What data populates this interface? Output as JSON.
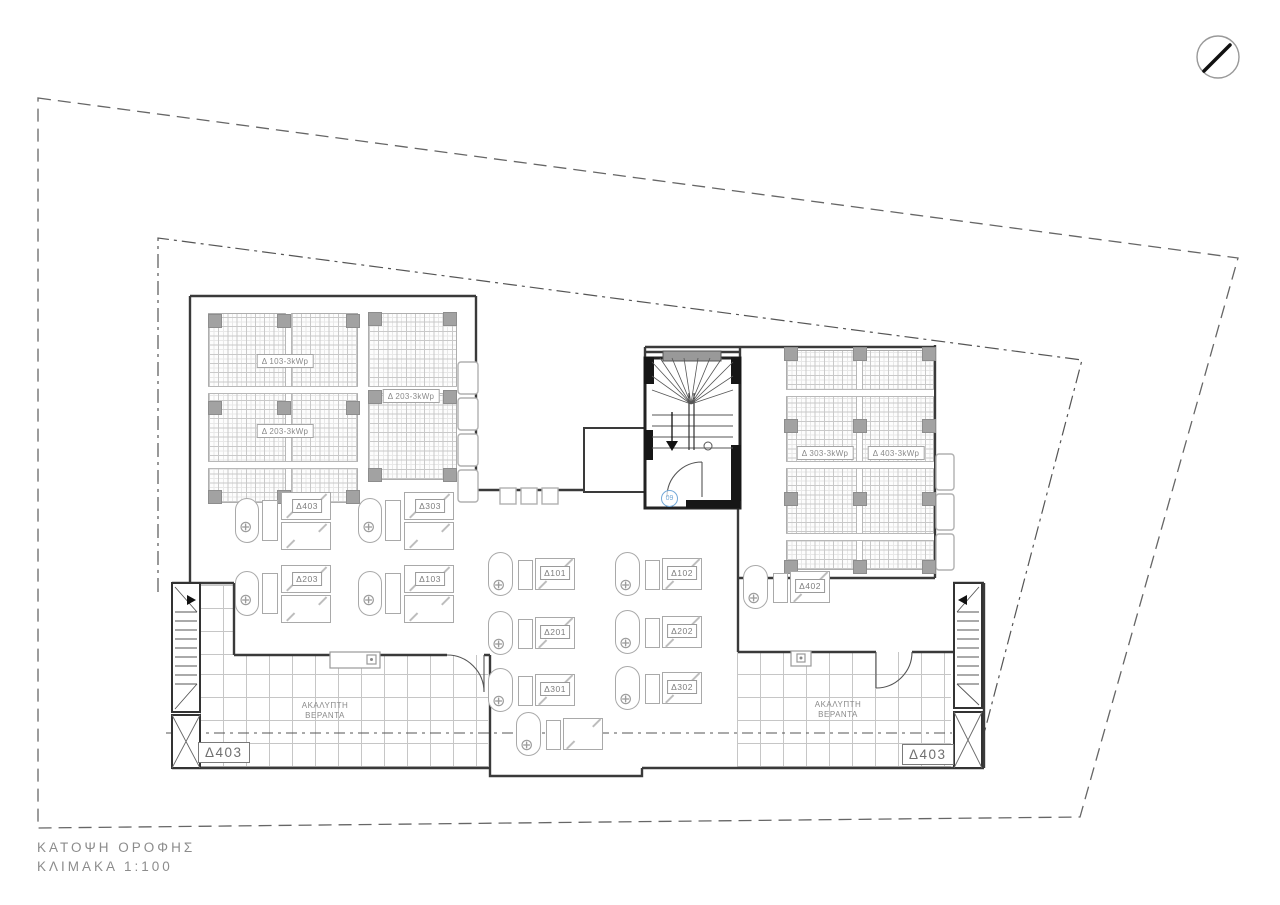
{
  "drawing": {
    "title": "ΚΑΤΟΨΗ ΟΡΟΦΗΣ",
    "scale": "ΚΛΙΜΑΚΑ 1:100",
    "veranda_line1": "ΑΚΑΛΥΠΤΗ",
    "veranda_line2": "ΒΕΡΑΝΤΑ",
    "apartment_tag": "Δ403",
    "door_tag": "09"
  },
  "colors": {
    "line": "#3a3a3a",
    "light_gray": "#aaaaaa",
    "column_gray": "#a2a2a2",
    "tag_blue": "#74a9d8"
  },
  "pv_arrays": [
    {
      "id": "pv-array-left-large",
      "x": 208,
      "y": 313,
      "w": 148,
      "h": 188,
      "vgap": 76,
      "hgaps": [
        72,
        147
      ],
      "labels": [
        {
          "text": "Δ 103-3kWp",
          "cx": 76,
          "cy": 47
        },
        {
          "text": "Δ 203-3kWp",
          "cx": 76,
          "cy": 117
        }
      ],
      "col_xs": [
        6,
        75,
        144
      ],
      "col_ys": [
        7,
        94,
        183
      ]
    },
    {
      "id": "pv-array-left-small",
      "x": 368,
      "y": 313,
      "w": 87,
      "h": 165,
      "vgap": null,
      "hgaps": [
        72
      ],
      "labels": [
        {
          "text": "Δ 203-3kWp",
          "cx": 42,
          "cy": 82
        }
      ],
      "col_xs": [
        6,
        81
      ],
      "col_ys": [
        5,
        83,
        161
      ]
    },
    {
      "id": "pv-array-right",
      "x": 786,
      "y": 350,
      "w": 146,
      "h": 218,
      "vgap": 69,
      "hgaps": [
        38,
        110,
        182
      ],
      "labels": [
        {
          "text": "Δ 303-3kWp",
          "cx": 38,
          "cy": 102
        },
        {
          "text": "Δ 403-3kWp",
          "cx": 109,
          "cy": 102
        }
      ],
      "col_xs": [
        4,
        73,
        142
      ],
      "col_ys": [
        3,
        75,
        148,
        216
      ]
    }
  ],
  "heater_units": [
    {
      "type": "A",
      "label": "Δ403",
      "x": 233,
      "y": 490
    },
    {
      "type": "A",
      "label": "Δ303",
      "x": 356,
      "y": 490
    },
    {
      "type": "A",
      "label": "Δ203",
      "x": 233,
      "y": 563
    },
    {
      "type": "A",
      "label": "Δ103",
      "x": 356,
      "y": 563
    },
    {
      "type": "B",
      "label": "Δ101",
      "x": 488,
      "y": 552
    },
    {
      "type": "B",
      "label": "Δ102",
      "x": 615,
      "y": 552
    },
    {
      "type": "B",
      "label": "Δ201",
      "x": 488,
      "y": 611
    },
    {
      "type": "B",
      "label": "Δ202",
      "x": 615,
      "y": 610
    },
    {
      "type": "B",
      "label": "Δ301",
      "x": 488,
      "y": 668
    },
    {
      "type": "B",
      "label": "Δ302",
      "x": 615,
      "y": 666
    },
    {
      "type": "B",
      "label": "",
      "x": 516,
      "y": 712
    },
    {
      "type": "B",
      "label": "Δ402",
      "x": 743,
      "y": 565
    }
  ]
}
